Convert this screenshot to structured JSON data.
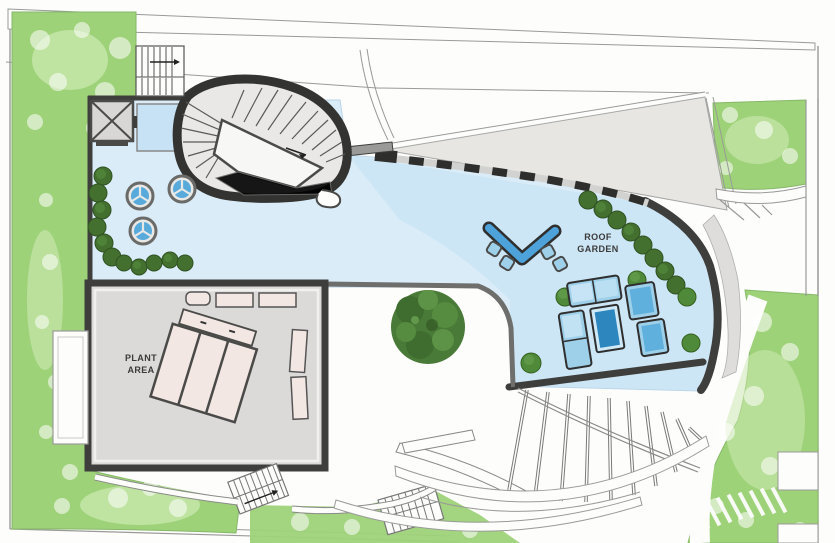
{
  "labels": {
    "roof_garden_line1": "ROOF",
    "roof_garden_line2": "GARDEN",
    "plant_area_line1": "PLANT",
    "plant_area_line2": "AREA"
  },
  "icons": {
    "elevator_x_brace": "X",
    "stair_direction_arrow": "→"
  },
  "colors": {
    "paper": "#fdfdfc",
    "lawn": "#9ed279",
    "lawn_light": "#cdeab2",
    "foliage_dark": "#44702f",
    "foliage_mid": "#568c3f",
    "bush": "#4f8a3b",
    "deck_blue": "#d9ecf8",
    "deck_blue_deep": "#c2dff2",
    "water_blue": "#4da3d9",
    "table_blue": "#2e86bf",
    "furniture_blue": "#9fd0ea",
    "furniture_light": "#cfe9f7",
    "wall_dark": "#3e3e3c",
    "wall_medium": "#6e6e6c",
    "roof_gray": "#e7e6e3",
    "room_gray": "#dcdad8",
    "equipment_pink": "#f3e7e4",
    "stair_fill": "#e9e8e6",
    "line_gray": "#9a9a98",
    "text": "#3a3a3a"
  }
}
